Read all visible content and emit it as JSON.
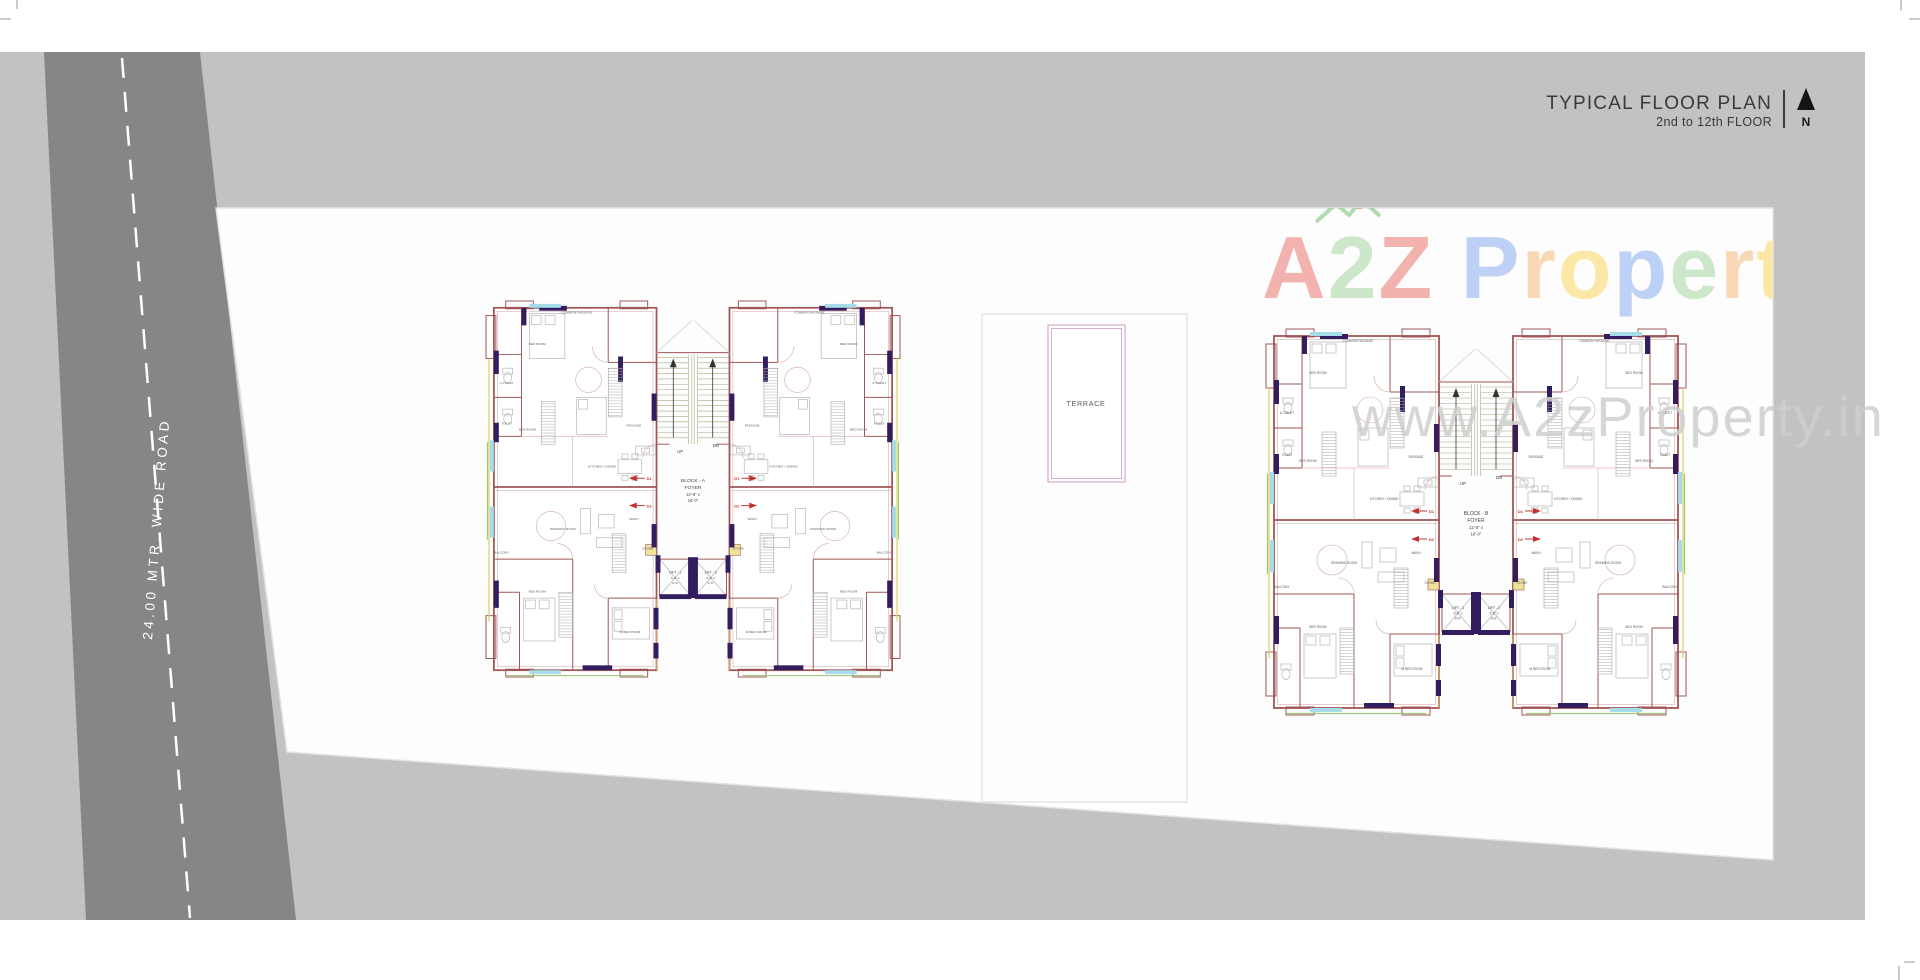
{
  "page": {
    "title": "TYPICAL FLOOR PLAN",
    "subtitle": "2nd to 12th FLOOR",
    "north_label": "N"
  },
  "road": {
    "label": "24.00 MTR. WIDE ROAD"
  },
  "watermark": {
    "brand_letters": [
      {
        "ch": "A",
        "color": "#f2b3ae"
      },
      {
        "ch": "2",
        "color": "#cde7cb"
      },
      {
        "ch": "Z",
        "color": "#f2b3ae"
      },
      {
        "ch": " ",
        "color": "#ffffff"
      },
      {
        "ch": "P",
        "color": "#bdd0f5"
      },
      {
        "ch": "r",
        "color": "#f9d9b5"
      },
      {
        "ch": "o",
        "color": "#fbe8a6"
      },
      {
        "ch": "p",
        "color": "#bdd0f5"
      },
      {
        "ch": "e",
        "color": "#cde7cb"
      },
      {
        "ch": "r",
        "color": "#f9d9b5"
      },
      {
        "ch": "t",
        "color": "#fbe8a6"
      },
      {
        "ch": "y",
        "color": "#cde7cb"
      }
    ],
    "url_text": "www.A2zProperty.in"
  },
  "terrace": {
    "label": "TERRACE"
  },
  "stair": {
    "up": "UP",
    "dn": "DN"
  },
  "door_tags": [
    "D1",
    "D2"
  ],
  "lifts": [
    {
      "name": "LIFT - 1",
      "size1": "6'-6\" x",
      "size2": "6'-6\""
    },
    {
      "name": "LIFT - 2",
      "size1": "6'-6\" x",
      "size2": "6'-6\""
    }
  ],
  "blocks": [
    {
      "name": "BLOCK - A",
      "foyer": "FOYER",
      "dim1": "12'-8\" x",
      "dim2": "16'-0\""
    },
    {
      "name": "BLOCK - B",
      "foyer": "FOYER",
      "dim1": "12'-8\" x",
      "dim2": "16'-0\""
    }
  ],
  "room_labels": [
    "BED ROOM",
    "BED ROOM",
    "A.TOILET",
    "TOILET",
    "KITCHEN + DINING",
    "DRAWING ROOM",
    "BED ROOM",
    "M.BED ROOM",
    "BALCONY",
    "WASH",
    "STORE",
    "PASSAGE",
    "COMMON PASSAGE"
  ],
  "colors": {
    "band": "#c3c1c4",
    "road": "#868686",
    "plot": "#fdfdfd",
    "wall": "#a05656",
    "pier_purple": "#321d5f",
    "window_cyan": "#a6dce9",
    "accent_yellow": "#ddd46e",
    "accent_green": "#9cc87b",
    "door_tag_red": "#c23232",
    "terrace_outline_pink": "#cf9ac4"
  }
}
